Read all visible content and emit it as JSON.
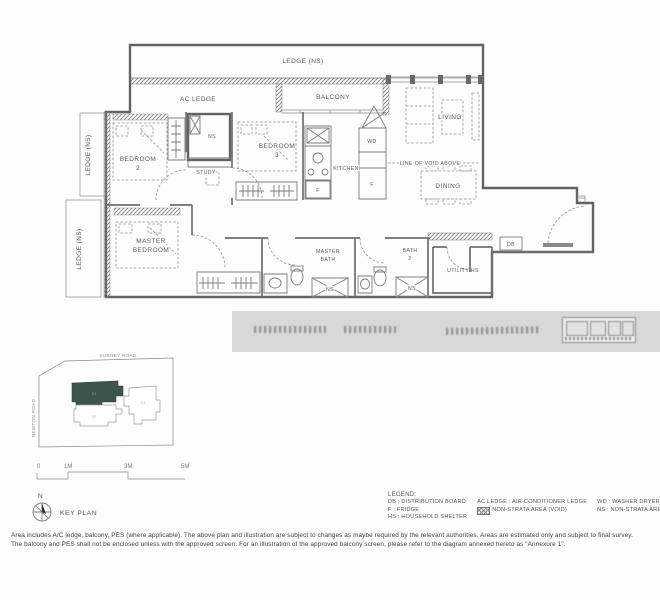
{
  "floor_plan": {
    "labels": {
      "ledge_top": "LEDGE (NS)",
      "ac_ledge": "AC LEDGE",
      "balcony": "BALCONY",
      "living": "LIVING",
      "ledge_left_upper": "LEDGE (NS)",
      "ledge_left_lower": "LEDGE (NS)",
      "bedroom2_l1": "BEDROOM",
      "bedroom2_l2": "2",
      "ns_shelter": "NS",
      "study": "STUDY",
      "bedroom3_l1": "BEDROOM",
      "bedroom3_l2": "3",
      "kitchen": "KITCHEN",
      "wd": "WD",
      "fridge_kitchen": "F",
      "fridge_column": "F",
      "line_of_void": "LINE OF VOID ABOVE",
      "dining": "DINING",
      "master_bedroom_l1": "MASTER",
      "master_bedroom_l2": "BEDROOM",
      "master_bath_l1": "MASTER",
      "master_bath_l2": "BATH",
      "ns_master_bath": "NS",
      "bath2_l1": "BATH",
      "bath2_l2": "2",
      "ns_bath2": "NS",
      "utility": "UTILITY-HS",
      "db": "DB"
    }
  },
  "key_plan": {
    "road_top": "SURREY ROAD",
    "road_left": "NEWTON ROAD",
    "blocks": [
      {
        "id": "01",
        "highlighted": true
      },
      {
        "id": "02",
        "highlighted": false
      },
      {
        "id": "03",
        "highlighted": false
      }
    ],
    "highlight_color": "#3d544d",
    "caption": "KEY PLAN",
    "north_label": "N"
  },
  "scale_bar": {
    "ticks": [
      "0",
      "1M",
      "3M",
      "5M"
    ]
  },
  "legend": {
    "title": "LEGEND:",
    "col1": [
      "DB : DISTRIBUTION BOARD",
      "F : FRIDGE",
      "HS : HOUSEHOLD SHELTER"
    ],
    "col2_row1": "AC LEDGE : AIR-CONDITIONER LEDGE",
    "col2_row2": "NON-STRATA AREA (VOID)",
    "col3": [
      "WD : WASHER DRYER",
      "NS : NON-STRATA AREA"
    ]
  },
  "disclaimer": [
    "Area includes A/C ledge, balcony, PES (where applicable). The above plan and illustration are subject to changes as maybe required by the relevant authorities. Areas are estimated only and subject to final survey.",
    "The balcony and PES shall not be enclosed unless with the approved screen. For an illustration of the approved balcony screen, please refer to the diagram annexed hereto as \"Annexure 1\"."
  ]
}
